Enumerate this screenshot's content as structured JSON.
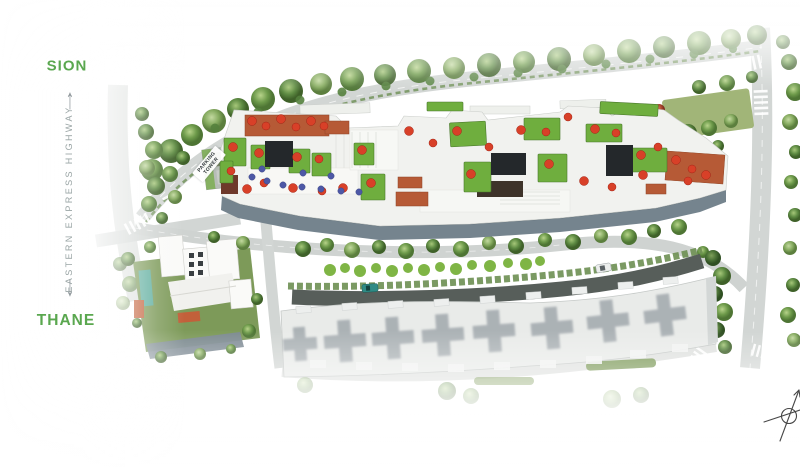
{
  "scene": {
    "description": "Aerial master-plan rendering of a residential development beside a highway",
    "labels": {
      "north_destination": "SION",
      "south_destination": "THANE",
      "highway_name": "EASTERN EXPRESS HIGHWAY",
      "parking_tower": "PARKING TOWER"
    },
    "icons": {
      "north_arrow": "↑",
      "south_arrow": "↓",
      "compass_rose": "compass-sketch"
    },
    "palette": {
      "label_green": "#5aa74f",
      "highway_label_gray": "#9aa5a5",
      "lawn_green": "#6fae3e",
      "foliage_green": "#7fae58",
      "deck_terracotta": "#b65a36",
      "rooftop_tree_red": "#d84028",
      "amenity_blue": "#4d58a6",
      "podium_facade_gray": "#75848e",
      "neighbor_building_gray": "#e9ebe9",
      "road_gray": "#d2d6d4",
      "driveway_dark": "#575e5a"
    }
  }
}
